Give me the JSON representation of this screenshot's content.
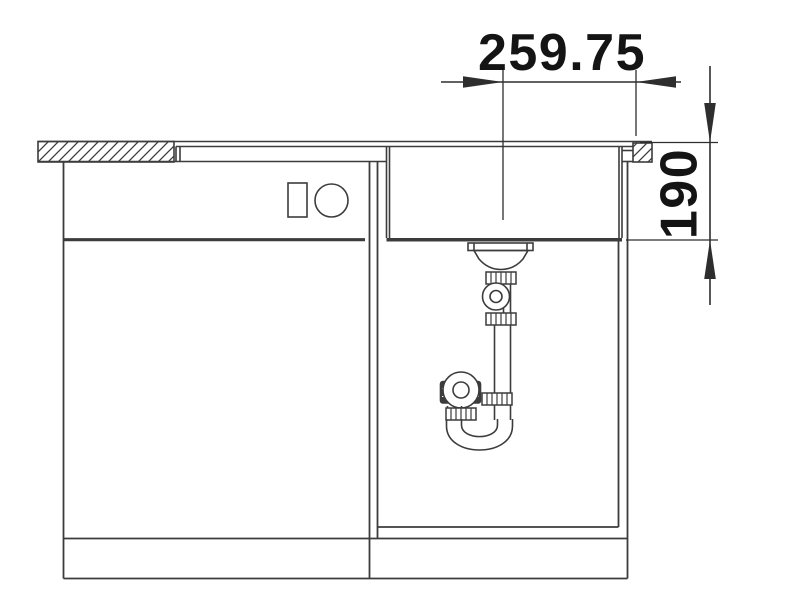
{
  "drawing": {
    "kind": "sink-cabinet-installation-front-view",
    "dimensions": {
      "horizontal": {
        "value": "259.75"
      },
      "vertical": {
        "value": "190"
      }
    },
    "colors": {
      "background": "#ffffff",
      "line": "#3c3c3c",
      "dimension": "#141414"
    }
  }
}
